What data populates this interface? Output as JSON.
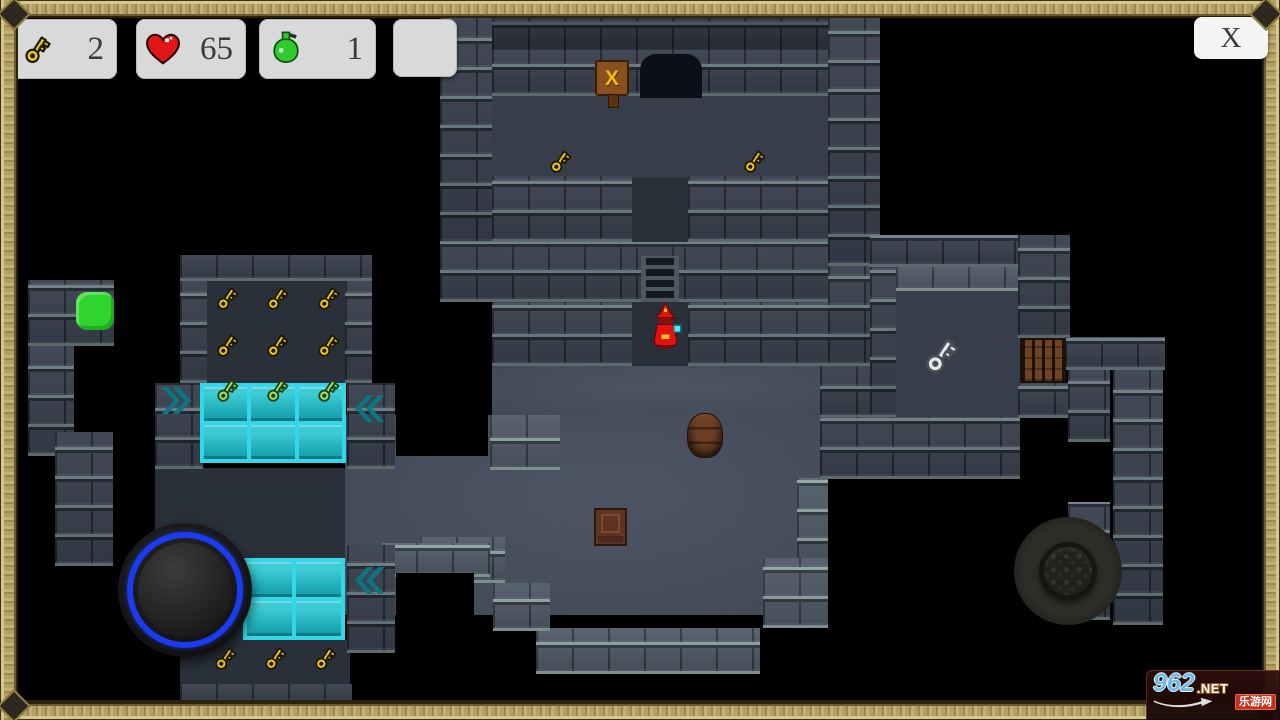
{
  "hud": {
    "keys": {
      "count": "2"
    },
    "health": {
      "count": "65"
    },
    "potions": {
      "count": "1"
    },
    "close_label": "X"
  },
  "watermark": {
    "site": "962",
    "domain": ".NET",
    "site_name": "乐游网"
  },
  "colors": {
    "gold": "#edc713",
    "gold_outline": "#1c1703",
    "green_key": "#a9dd5c",
    "green_key_outline": "#17401c",
    "silver": "#e6e9ec",
    "silver_outline": "#4a4f55",
    "tile_cyan": "#2bd0e0",
    "chevron_teal": "#0b7680",
    "slime_green": "#2fd42f",
    "wizard_red": "#e01212",
    "joystick_ring_blue": "#1b3bf0",
    "heart_red": "#e31616",
    "potion_green": "#2ecb2e"
  },
  "map": {
    "tiles": [
      {
        "c": "floor-mid",
        "x": 492,
        "y": 96,
        "w": 336,
        "h": 86
      },
      {
        "c": "floor-dark",
        "x": 632,
        "y": 178,
        "w": 56,
        "h": 66
      },
      {
        "c": "floor-dark",
        "x": 632,
        "y": 302,
        "w": 56,
        "h": 66
      },
      {
        "c": "floor-light",
        "x": 492,
        "y": 366,
        "w": 328,
        "h": 52
      },
      {
        "c": "floor-light",
        "x": 345,
        "y": 415,
        "w": 475,
        "h": 200
      },
      {
        "c": "floor-mid",
        "x": 895,
        "y": 278,
        "w": 125,
        "h": 140
      },
      {
        "c": "floor-dark",
        "x": 207,
        "y": 278,
        "w": 138,
        "h": 105
      },
      {
        "c": "floor-dark",
        "x": 155,
        "y": 468,
        "w": 190,
        "h": 92
      },
      {
        "c": "floor-dark",
        "x": 175,
        "y": 558,
        "w": 77,
        "h": 84
      },
      {
        "c": "floor-dark",
        "x": 180,
        "y": 640,
        "w": 170,
        "h": 44
      },
      {
        "c": "wall",
        "x": 440,
        "y": 18,
        "w": 52,
        "h": 226
      },
      {
        "c": "wall",
        "x": 828,
        "y": 18,
        "w": 52,
        "h": 248
      },
      {
        "c": "wall-dark",
        "x": 492,
        "y": 18,
        "w": 336,
        "h": 36
      },
      {
        "c": "wall",
        "x": 492,
        "y": 50,
        "w": 336,
        "h": 46
      },
      {
        "c": "wall",
        "x": 492,
        "y": 176,
        "w": 140,
        "h": 66
      },
      {
        "c": "wall",
        "x": 688,
        "y": 176,
        "w": 140,
        "h": 66
      },
      {
        "c": "wall",
        "x": 440,
        "y": 242,
        "w": 196,
        "h": 60
      },
      {
        "c": "wall",
        "x": 636,
        "y": 242,
        "w": 48,
        "h": 60
      },
      {
        "c": "wall",
        "x": 684,
        "y": 242,
        "w": 144,
        "h": 60
      },
      {
        "c": "wall",
        "x": 492,
        "y": 302,
        "w": 140,
        "h": 64
      },
      {
        "c": "wall",
        "x": 688,
        "y": 302,
        "w": 140,
        "h": 64
      },
      {
        "c": "wall",
        "x": 828,
        "y": 266,
        "w": 52,
        "h": 100
      },
      {
        "c": "wall",
        "x": 820,
        "y": 366,
        "w": 58,
        "h": 52
      },
      {
        "c": "wall-lit",
        "x": 797,
        "y": 478,
        "w": 31,
        "h": 92
      },
      {
        "c": "wall-lit",
        "x": 763,
        "y": 558,
        "w": 65,
        "h": 70
      },
      {
        "c": "wall-lit",
        "x": 536,
        "y": 628,
        "w": 224,
        "h": 46
      },
      {
        "c": "wall-lit",
        "x": 420,
        "y": 537,
        "w": 85,
        "h": 46
      },
      {
        "c": "wall-lit",
        "x": 493,
        "y": 583,
        "w": 57,
        "h": 48
      },
      {
        "c": "wall-lit",
        "x": 490,
        "y": 415,
        "w": 70,
        "h": 55
      },
      {
        "c": "wall-lit",
        "x": 380,
        "y": 543,
        "w": 110,
        "h": 34
      },
      {
        "c": "wall",
        "x": 870,
        "y": 235,
        "w": 200,
        "h": 32
      },
      {
        "c": "wall-lit",
        "x": 896,
        "y": 267,
        "w": 122,
        "h": 24
      },
      {
        "c": "wall",
        "x": 870,
        "y": 267,
        "w": 26,
        "h": 151
      },
      {
        "c": "wall",
        "x": 1018,
        "y": 235,
        "w": 52,
        "h": 103
      },
      {
        "c": "wall",
        "x": 1018,
        "y": 383,
        "w": 52,
        "h": 35
      },
      {
        "c": "wall",
        "x": 820,
        "y": 417,
        "w": 200,
        "h": 62
      },
      {
        "c": "wall",
        "x": 1065,
        "y": 337,
        "w": 100,
        "h": 33
      },
      {
        "c": "wall",
        "x": 1068,
        "y": 370,
        "w": 42,
        "h": 72
      },
      {
        "c": "wall",
        "x": 1068,
        "y": 502,
        "w": 42,
        "h": 118
      },
      {
        "c": "wall",
        "x": 1113,
        "y": 370,
        "w": 50,
        "h": 255
      },
      {
        "c": "wall",
        "x": 180,
        "y": 255,
        "w": 192,
        "h": 26
      },
      {
        "c": "wall",
        "x": 180,
        "y": 281,
        "w": 27,
        "h": 102
      },
      {
        "c": "wall",
        "x": 345,
        "y": 281,
        "w": 27,
        "h": 102
      },
      {
        "c": "wall",
        "x": 155,
        "y": 383,
        "w": 48,
        "h": 86
      },
      {
        "c": "wall",
        "x": 347,
        "y": 383,
        "w": 48,
        "h": 86
      },
      {
        "c": "wall",
        "x": 347,
        "y": 545,
        "w": 48,
        "h": 108
      },
      {
        "c": "wall",
        "x": 180,
        "y": 684,
        "w": 172,
        "h": 20
      },
      {
        "c": "wall",
        "x": 28,
        "y": 280,
        "w": 86,
        "h": 66
      },
      {
        "c": "wall",
        "x": 28,
        "y": 346,
        "w": 46,
        "h": 110
      },
      {
        "c": "wall",
        "x": 55,
        "y": 432,
        "w": 58,
        "h": 134
      },
      {
        "c": "void",
        "x": 396,
        "y": 400,
        "w": 92,
        "h": 56
      },
      {
        "c": "void",
        "x": 396,
        "y": 573,
        "w": 78,
        "h": 57
      }
    ],
    "items": [
      {
        "type": "tiles",
        "x": 200,
        "y": 383,
        "w": 146,
        "h": 80,
        "cols": 3,
        "rows": 2
      },
      {
        "type": "tiles",
        "x": 243,
        "y": 558,
        "w": 102,
        "h": 82,
        "cols": 2,
        "rows": 2
      },
      {
        "type": "gold-key",
        "x": 545,
        "y": 146,
        "w": 30,
        "h": 30
      },
      {
        "type": "gold-key",
        "x": 739,
        "y": 146,
        "w": 30,
        "h": 30
      },
      {
        "type": "gold-key",
        "x": 212,
        "y": 283,
        "w": 30,
        "h": 30
      },
      {
        "type": "gold-key",
        "x": 262,
        "y": 283,
        "w": 30,
        "h": 30
      },
      {
        "type": "gold-key",
        "x": 313,
        "y": 283,
        "w": 30,
        "h": 30
      },
      {
        "type": "gold-key",
        "x": 212,
        "y": 330,
        "w": 30,
        "h": 30
      },
      {
        "type": "gold-key",
        "x": 262,
        "y": 330,
        "w": 30,
        "h": 30
      },
      {
        "type": "gold-key",
        "x": 313,
        "y": 330,
        "w": 30,
        "h": 30
      },
      {
        "type": "green-key",
        "x": 212,
        "y": 375,
        "w": 30,
        "h": 30
      },
      {
        "type": "green-key",
        "x": 262,
        "y": 375,
        "w": 30,
        "h": 30
      },
      {
        "type": "green-key",
        "x": 313,
        "y": 375,
        "w": 30,
        "h": 30
      },
      {
        "type": "gold-key",
        "x": 210,
        "y": 643,
        "w": 30,
        "h": 30
      },
      {
        "type": "gold-key",
        "x": 260,
        "y": 643,
        "w": 30,
        "h": 30
      },
      {
        "type": "gold-key",
        "x": 310,
        "y": 643,
        "w": 30,
        "h": 30
      },
      {
        "type": "silver-key",
        "x": 918,
        "y": 330,
        "w": 46,
        "h": 50
      },
      {
        "type": "chevron-right",
        "x": 161,
        "y": 387,
        "w": 33,
        "h": 27
      },
      {
        "type": "chevron-left",
        "x": 352,
        "y": 395,
        "w": 33,
        "h": 27
      },
      {
        "type": "chevron-left",
        "x": 352,
        "y": 567,
        "w": 33,
        "h": 27
      },
      {
        "type": "wizard",
        "x": 649,
        "y": 302,
        "w": 33,
        "h": 48
      },
      {
        "type": "ladder",
        "x": 641,
        "y": 256,
        "w": 38,
        "h": 46
      },
      {
        "type": "doorway",
        "x": 640,
        "y": 54,
        "w": 62,
        "h": 44
      },
      {
        "type": "sign",
        "x": 595,
        "y": 60,
        "w": 34,
        "h": 36,
        "label": "X"
      },
      {
        "type": "gate",
        "x": 1020,
        "y": 338,
        "w": 46,
        "h": 45
      },
      {
        "type": "barrel",
        "x": 687,
        "y": 413,
        "w": 36,
        "h": 45
      },
      {
        "type": "chest",
        "x": 594,
        "y": 508,
        "w": 33,
        "h": 38
      },
      {
        "type": "green-slime",
        "x": 76,
        "y": 292,
        "w": 38,
        "h": 38
      }
    ]
  }
}
